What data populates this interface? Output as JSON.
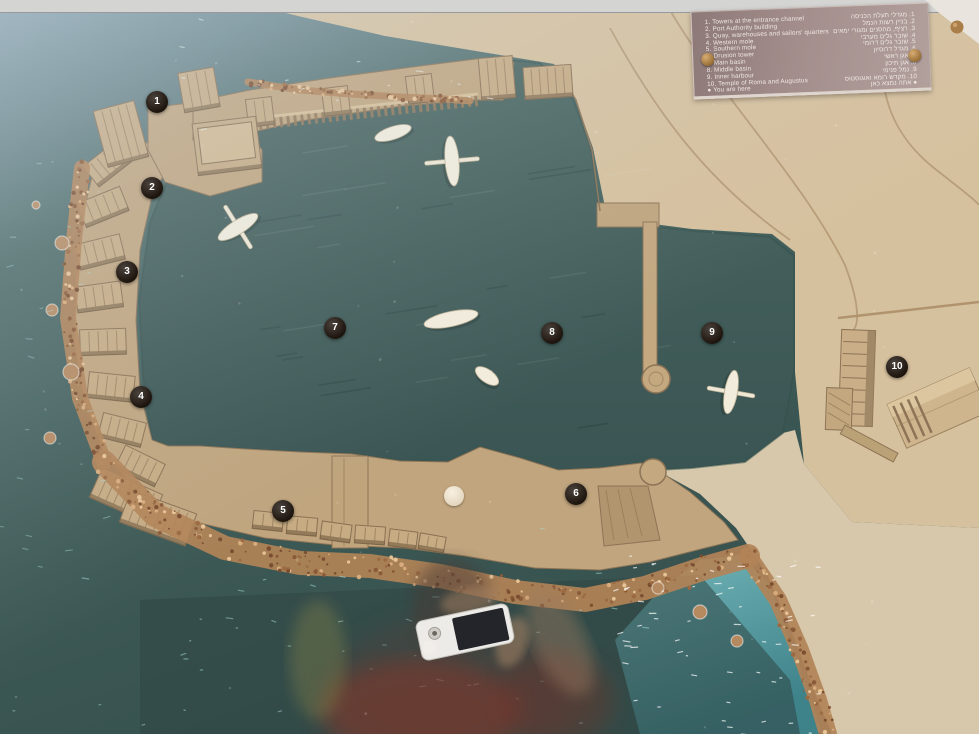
{
  "scene": {
    "caption": "Scale model of an ancient harbour displayed under glass",
    "colors": {
      "harbor_water": "#3f5b58",
      "open_sea": "#47635f",
      "shallow_sea": "#5fa5ad",
      "sand_moles": "#c0a57e",
      "land": "#d6c19e",
      "rocks": "#b58a5f",
      "plaque": "#a38e8c",
      "marker_background": "#1d1510",
      "marker_text": "#ffffff"
    }
  },
  "legend": {
    "items": [
      {
        "num": "1",
        "en": "Towers at the entrance channel",
        "he": "מגדלי תעלת הכניסה"
      },
      {
        "num": "2",
        "en": "Port Authority building",
        "he": "בניין רשות הנמל"
      },
      {
        "num": "3",
        "en": "Quay, warehouses and sailors' quarters",
        "he": "רציף, מחסנים ומגורי ימאים"
      },
      {
        "num": "4",
        "en": "Western mole",
        "he": "שובר גלים מערבי"
      },
      {
        "num": "5",
        "en": "Southern mole",
        "he": "שובר גלים דרומי"
      },
      {
        "num": "6",
        "en": "Drusion tower",
        "he": "מגדל דרוסיון"
      },
      {
        "num": "7",
        "en": "Main basin",
        "he": "אגן ראשי"
      },
      {
        "num": "8",
        "en": "Middle basin",
        "he": "אגן תיכון"
      },
      {
        "num": "9",
        "en": "Inner harbour",
        "he": "נמל פנימי"
      },
      {
        "num": "10",
        "en": "Temple of Roma and Augustus",
        "he": "מקדש רומא ואוגוסטוס"
      }
    ],
    "you_are_here": {
      "en": "You are here",
      "he": "אתה נמצא כאן"
    }
  },
  "markers": [
    {
      "label": "1",
      "x": 157,
      "y": 102
    },
    {
      "label": "2",
      "x": 152,
      "y": 188
    },
    {
      "label": "3",
      "x": 127,
      "y": 272
    },
    {
      "label": "4",
      "x": 141,
      "y": 397
    },
    {
      "label": "5",
      "x": 283,
      "y": 511
    },
    {
      "label": "6",
      "x": 576,
      "y": 494
    },
    {
      "label": "7",
      "x": 335,
      "y": 328
    },
    {
      "label": "8",
      "x": 552,
      "y": 333
    },
    {
      "label": "9",
      "x": 712,
      "y": 333
    },
    {
      "label": "10",
      "x": 897,
      "y": 367
    }
  ],
  "you_are_here_disc": {
    "x": 454,
    "y": 496
  }
}
